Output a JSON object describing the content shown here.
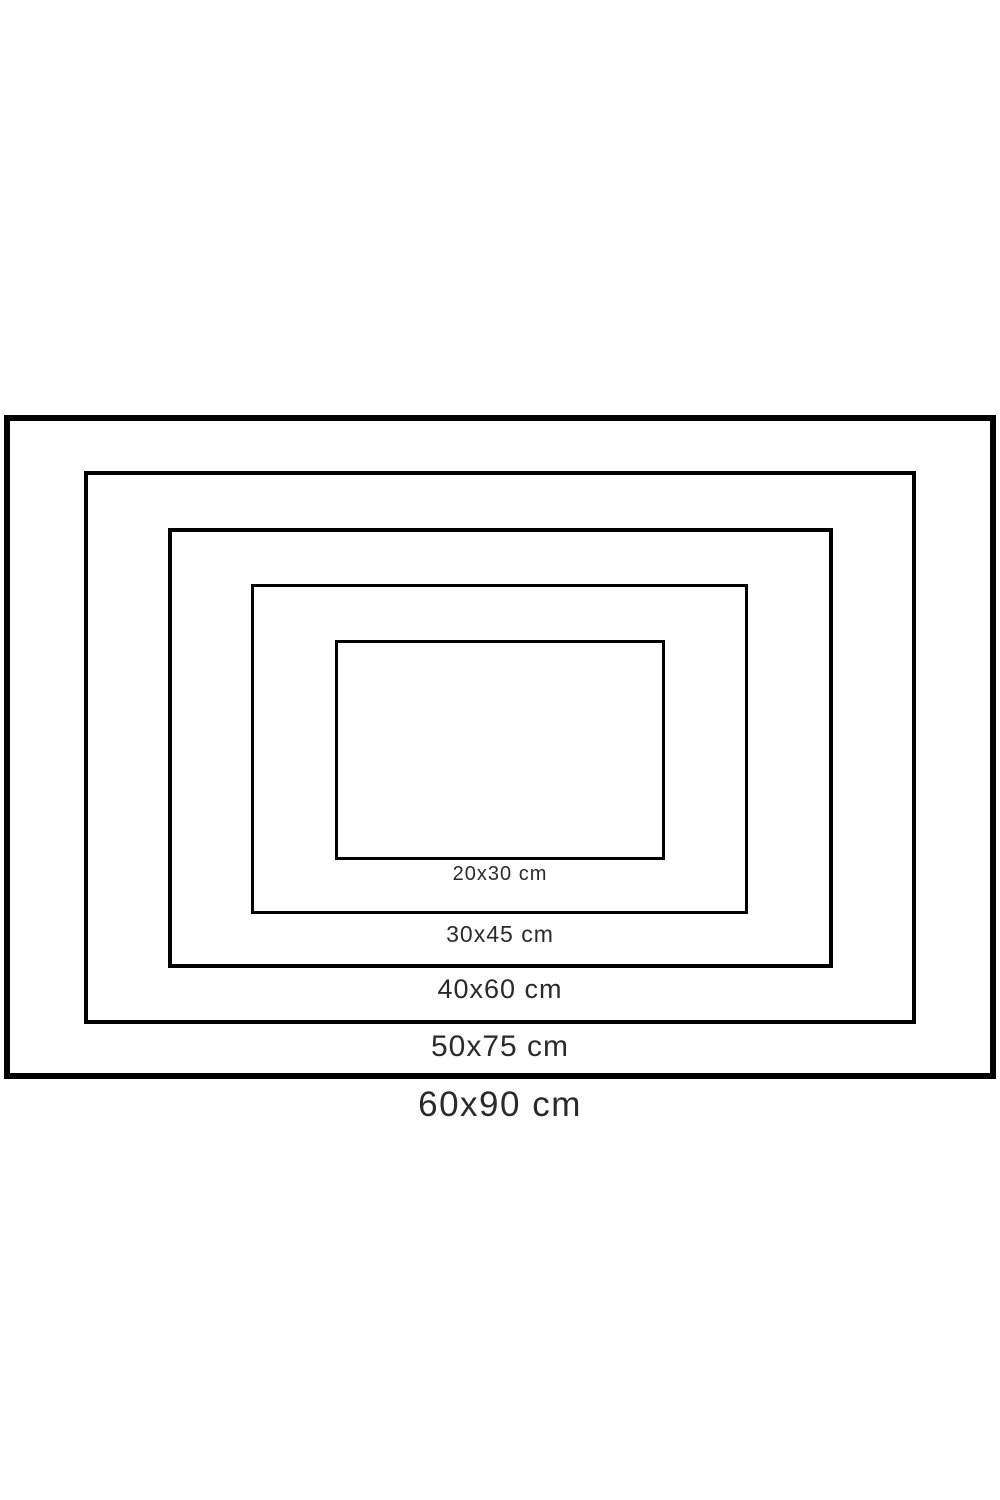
{
  "diagram": {
    "description": "Nested rectangles comparing print sizes",
    "line_color": "#000000",
    "text_color": "#2a2a2a",
    "background_color": "#ffffff",
    "sizes": [
      {
        "label": "20x30 cm"
      },
      {
        "label": "30x45 cm"
      },
      {
        "label": "40x60 cm"
      },
      {
        "label": "50x75 cm"
      },
      {
        "label": "60x90 cm"
      }
    ]
  }
}
